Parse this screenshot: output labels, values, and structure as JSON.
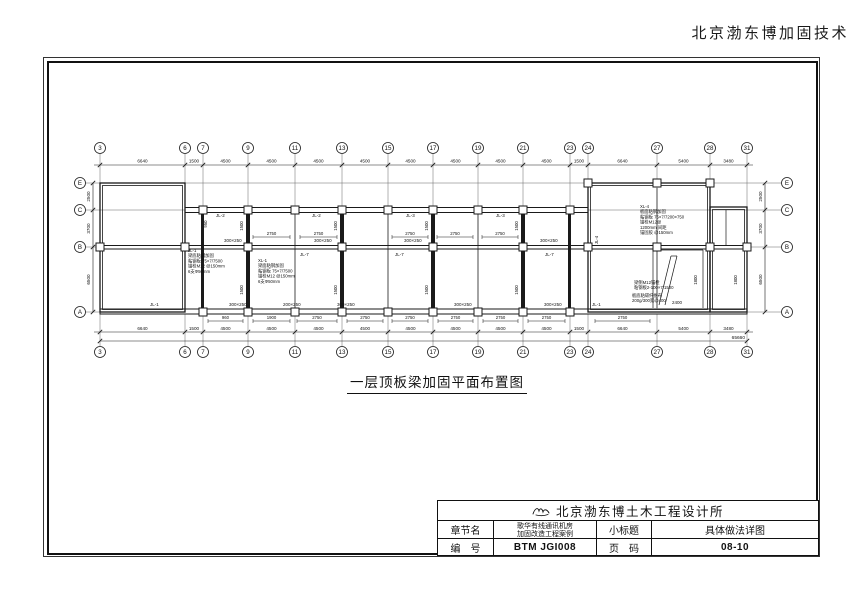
{
  "header": {
    "brand": "北京渤东博加固技术"
  },
  "caption": {
    "title": "一层顶板梁加固平面布置图"
  },
  "titleblock": {
    "firm": "北京渤东博土木工程设计所",
    "logo_icon": "calligraphy-mark",
    "chapter_label": "章节名",
    "chapter_line1": "歌华有线通讯机房",
    "chapter_line2": "加固改造工程案例",
    "subtitle_label": "小标题",
    "subtitle_value": "具体做法详图",
    "number_label": "编　号",
    "number_value": "BTM JGI008",
    "page_label": "页　码",
    "page_value": "08-10"
  },
  "plan": {
    "ink": "#1a1a1a",
    "grid_color": "#666",
    "cols": [
      [
        "3",
        100
      ],
      [
        "6",
        185
      ],
      [
        "7",
        203
      ],
      [
        "9",
        248
      ],
      [
        "11",
        295
      ],
      [
        "13",
        342
      ],
      [
        "15",
        388
      ],
      [
        "17",
        433
      ],
      [
        "19",
        478
      ],
      [
        "21",
        523
      ],
      [
        "23",
        570
      ],
      [
        "24",
        588
      ],
      [
        "27",
        657
      ],
      [
        "28",
        710
      ],
      [
        "31",
        747
      ]
    ],
    "rows": [
      [
        "E",
        183
      ],
      [
        "C",
        210
      ],
      [
        "B",
        247
      ],
      [
        "A",
        312
      ]
    ],
    "top_dims": [
      "6640",
      "1500",
      "4500",
      "4500",
      "4500",
      "4500",
      "4500",
      "4500",
      "4500",
      "4500",
      "1500",
      "6640",
      "5400",
      "3480"
    ],
    "bottom_dims": [
      "6640",
      "1500",
      "4500",
      "4500",
      "4500",
      "4500",
      "4500",
      "4500",
      "4500",
      "4500",
      "1500",
      "6640",
      "5400",
      "3480"
    ],
    "total_dim": "65660",
    "side_dims": [
      "2500",
      "3700",
      "6500"
    ],
    "wall_blocks": [
      [
        100,
        183,
        85,
        129
      ],
      [
        588,
        183,
        122,
        129
      ],
      [
        710,
        207,
        37,
        105
      ]
    ],
    "wall_strips": [
      [
        185,
        207.5,
        403,
        5
      ],
      [
        100,
        309,
        647,
        5
      ],
      [
        185,
        245.5,
        562,
        3.5
      ],
      [
        100,
        245.5,
        85,
        3.5
      ]
    ],
    "solid_walls": [
      [
        201,
        212,
        3,
        96
      ],
      [
        246,
        212,
        4,
        96
      ],
      [
        340,
        212,
        4,
        96
      ],
      [
        431,
        212,
        4,
        96
      ],
      [
        521,
        212,
        4,
        96
      ],
      [
        568,
        212,
        3,
        96
      ]
    ],
    "part_lines": [
      [
        295,
        212,
        295,
        308
      ],
      [
        388,
        212,
        388,
        308
      ],
      [
        478,
        212,
        478,
        308
      ],
      [
        657,
        188,
        657,
        308
      ],
      [
        726,
        210,
        726,
        245
      ],
      [
        653,
        250,
        703,
        250
      ],
      [
        653,
        250,
        653,
        308
      ],
      [
        703,
        250,
        703,
        308
      ],
      [
        659,
        305,
        671,
        256
      ],
      [
        671,
        256,
        677,
        256
      ],
      [
        677,
        256,
        665,
        305
      ]
    ],
    "columns_C": [
      203,
      248,
      295,
      342,
      388,
      433,
      478,
      523,
      570
    ],
    "columns_B": [
      100,
      185,
      248,
      342,
      433,
      523,
      588,
      657,
      710,
      747
    ],
    "columns_A": [
      203,
      248,
      295,
      342,
      388,
      433,
      478,
      523,
      570
    ],
    "columns_E": [
      588,
      657,
      710
    ],
    "labels": [
      [
        216,
        217,
        "JL-2"
      ],
      [
        312,
        217,
        "JL-2"
      ],
      [
        406,
        217,
        "JL-3"
      ],
      [
        496,
        217,
        "JL-3"
      ],
      [
        150,
        306,
        "JL-1"
      ],
      [
        592,
        306,
        "JL-1"
      ],
      [
        300,
        256,
        "JL-7"
      ],
      [
        395,
        256,
        "JL-7"
      ],
      [
        545,
        256,
        "JL-7"
      ],
      [
        224,
        242,
        "300×250"
      ],
      [
        314,
        242,
        "300×250"
      ],
      [
        404,
        242,
        "300×250"
      ],
      [
        540,
        242,
        "300×250"
      ],
      [
        229,
        306,
        "300×250"
      ],
      [
        283,
        306,
        "200×250"
      ],
      [
        337,
        306,
        "300×250"
      ],
      [
        454,
        306,
        "300×250"
      ],
      [
        544,
        306,
        "300×250"
      ],
      [
        672,
        304,
        "2400"
      ]
    ],
    "notes": [
      [
        188,
        252,
        [
          "JL-1",
          "梁底粘钢加固",
          "粘钢板 75×7/7500",
          "锚栓M12 @150mm",
          "6支Φ50mm"
        ]
      ],
      [
        258,
        262,
        [
          "XL-1",
          "梁面粘钢加固",
          "粘钢板 75×7/7500",
          "锚栓M12 @150mm",
          "6支Φ50mm"
        ]
      ],
      [
        640,
        208,
        [
          "XL-4",
          "板面粘钢加固",
          "粘钢板 75×7/7200×750",
          "锚栓M12@",
          "1200mm 间距",
          "锚固胶 @150mm"
        ]
      ],
      [
        634,
        284,
        [
          "梁侧M12锚栓",
          "粘钢板2-100×7/1500"
        ]
      ],
      [
        632,
        297,
        [
          "板底粘碳纤维布",
          "200g/300宽@400"
        ]
      ]
    ],
    "beam_dims": [
      [
        253,
        290,
        "2750"
      ],
      [
        300,
        337,
        "2750"
      ],
      [
        392,
        428,
        "2750"
      ],
      [
        437,
        473,
        "2750"
      ],
      [
        482,
        518,
        "2750"
      ]
    ],
    "window_dims": [
      [
        208,
        243,
        "960"
      ],
      [
        253,
        290,
        "1900"
      ],
      [
        297,
        337,
        "2750"
      ],
      [
        347,
        383,
        "2750"
      ],
      [
        392,
        428,
        "2750"
      ],
      [
        438,
        473,
        "2750"
      ],
      [
        483,
        518,
        "2750"
      ],
      [
        528,
        565,
        "2750"
      ],
      [
        595,
        650,
        "2750"
      ]
    ],
    "rot_dims": [
      [
        243,
        226,
        "1500"
      ],
      [
        243,
        290,
        "1500"
      ],
      [
        337,
        226,
        "1500"
      ],
      [
        337,
        290,
        "1500"
      ],
      [
        428,
        226,
        "1500"
      ],
      [
        428,
        290,
        "1500"
      ],
      [
        518,
        226,
        "1500"
      ],
      [
        518,
        290,
        "1500"
      ],
      [
        207,
        224,
        "950"
      ],
      [
        598,
        240,
        "JL-4"
      ],
      [
        697,
        280,
        "1800"
      ],
      [
        737,
        280,
        "1800"
      ]
    ]
  }
}
